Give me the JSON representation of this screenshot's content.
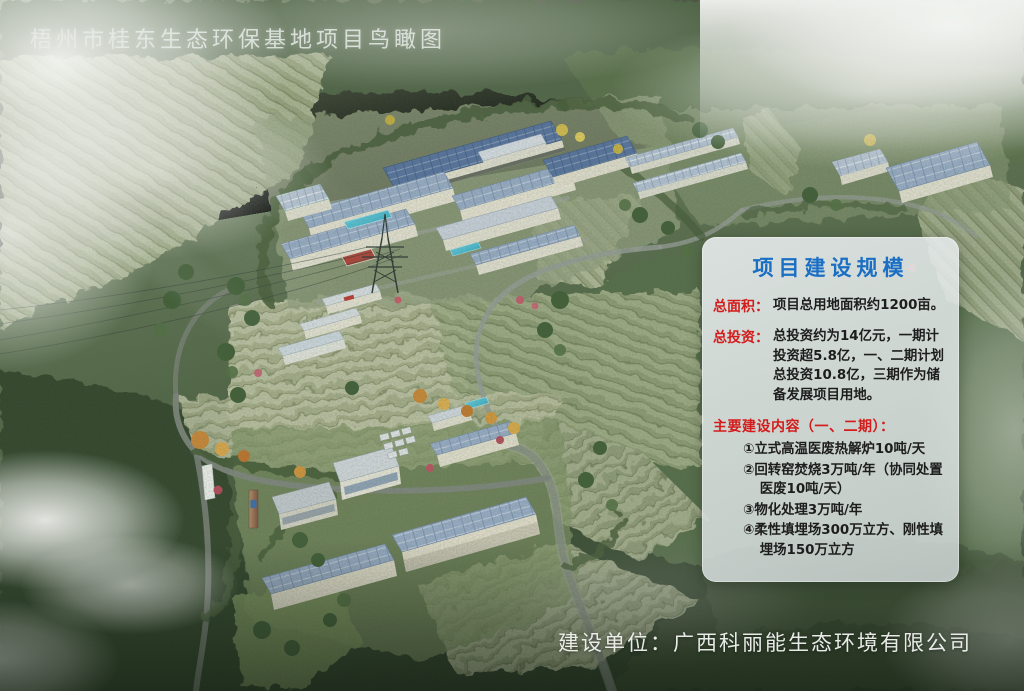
{
  "title": "梧州市桂东生态环保基地项目鸟瞰图",
  "info_panel": {
    "header": "项目建设规模",
    "area_label": "总面积：",
    "area_text": "项目总用地面积约1200亩。",
    "invest_label": "总投资：",
    "invest_text": "总投资约为14亿元，一期计投资超5.8亿，一、二期计划总投资10.8亿，三期作为储备发展项目用地。",
    "content_label": "主要建设内容（一、二期）：",
    "items": [
      "①立式高温医废热解炉10吨/天",
      "②回转窑焚烧3万吨/年（协同处置医废10吨/天）",
      "③物化处理3万吨/年",
      "④柔性填埋场300万立方、刚性填埋场150万立方"
    ]
  },
  "footer": {
    "builder_line": "建设单位：广西科丽能生态环境有限公司"
  },
  "colors": {
    "panel_header_blue": "#1a6fc4",
    "panel_label_red": "#d31c1c",
    "panel_body_text": "#1d1d1d",
    "title_white": "#e8ece7",
    "solar_roof_dark": "#5b76a4",
    "solar_roof_light": "#9db0cc",
    "pool_cyan": "#3fc4da",
    "court_red": "#b5433c",
    "forest_green_dark": "#35462f",
    "terrace_khaki": "#b7bf9e"
  }
}
